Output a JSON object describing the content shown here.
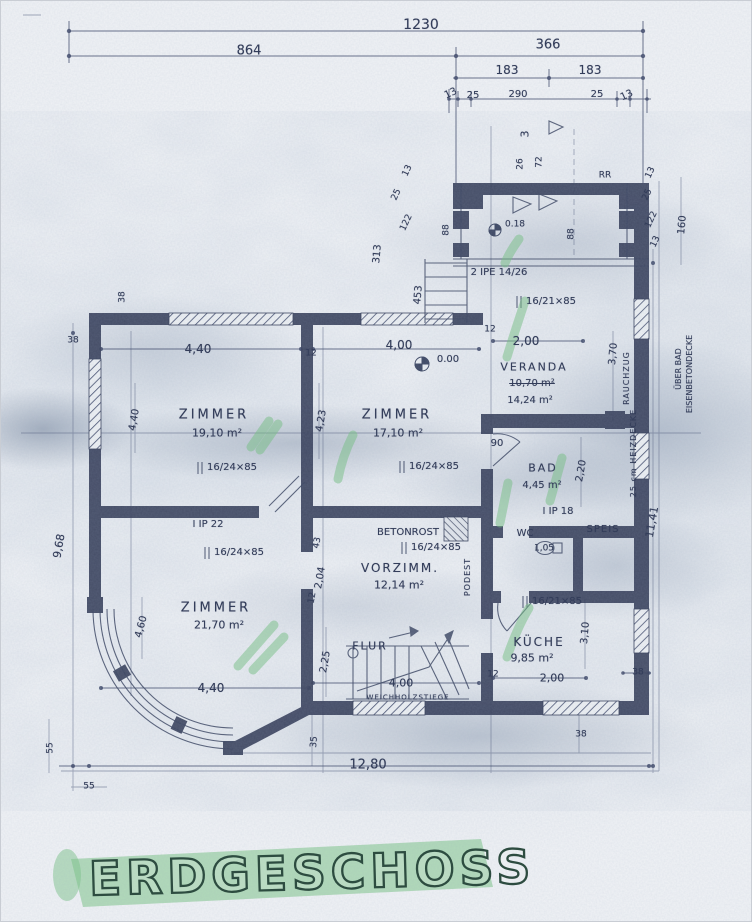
{
  "title": {
    "text": "ERDGESCHOSS"
  },
  "colors": {
    "paper": "#f1f3f6",
    "ink": "#333d5a",
    "wall": "#39415c",
    "highlight_green": "#7cc487",
    "title_ink": "#2d4c40"
  },
  "labels": [
    {
      "name": "dim-total-width",
      "text": "1230",
      "x": 420,
      "y": 24,
      "size": 14
    },
    {
      "name": "dim-864",
      "text": "864",
      "x": 248,
      "y": 50,
      "size": 13
    },
    {
      "name": "dim-366",
      "text": "366",
      "x": 547,
      "y": 44,
      "size": 13
    },
    {
      "name": "dim-183-left",
      "text": "183",
      "x": 506,
      "y": 69,
      "size": 12
    },
    {
      "name": "dim-183-right",
      "text": "183",
      "x": 589,
      "y": 69,
      "size": 12
    },
    {
      "name": "dim-13-a",
      "text": "13",
      "x": 450,
      "y": 93,
      "size": 10,
      "rot": -25
    },
    {
      "name": "dim-25-a",
      "text": "25",
      "x": 472,
      "y": 95,
      "size": 10
    },
    {
      "name": "dim-290",
      "text": "290",
      "x": 517,
      "y": 94,
      "size": 10
    },
    {
      "name": "dim-25-b",
      "text": "25",
      "x": 596,
      "y": 94,
      "size": 10
    },
    {
      "name": "dim-13-b",
      "text": "13",
      "x": 626,
      "y": 95,
      "size": 10,
      "rot": -25
    },
    {
      "name": "dim-3",
      "text": "3",
      "x": 524,
      "y": 133,
      "size": 11,
      "rot": -90
    },
    {
      "name": "dim-26",
      "text": "26",
      "x": 520,
      "y": 163,
      "size": 9,
      "rot": -90
    },
    {
      "name": "dim-72",
      "text": "72",
      "x": 539,
      "y": 161,
      "size": 9,
      "rot": -90
    },
    {
      "name": "note-rr",
      "text": "RR",
      "x": 604,
      "y": 175,
      "size": 9
    },
    {
      "name": "dim-13-porch-left",
      "text": "13",
      "x": 407,
      "y": 170,
      "size": 9,
      "rot": -65
    },
    {
      "name": "dim-25-porch-left",
      "text": "25",
      "x": 396,
      "y": 194,
      "size": 9,
      "rot": -65
    },
    {
      "name": "dim-122-left",
      "text": "122",
      "x": 406,
      "y": 222,
      "size": 9,
      "rot": -65
    },
    {
      "name": "dim-313",
      "text": "313",
      "x": 377,
      "y": 253,
      "size": 10,
      "rot": -85
    },
    {
      "name": "dim-453",
      "text": "453",
      "x": 418,
      "y": 294,
      "size": 10,
      "rot": -85
    },
    {
      "name": "dim-88-left",
      "text": "88",
      "x": 446,
      "y": 229,
      "size": 9,
      "rot": -90
    },
    {
      "name": "dim-88-right",
      "text": "88",
      "x": 571,
      "y": 233,
      "size": 9,
      "rot": -90
    },
    {
      "name": "dim-13-porch-right",
      "text": "13",
      "x": 650,
      "y": 172,
      "size": 9,
      "rot": -65
    },
    {
      "name": "dim-25-porch-right",
      "text": "25",
      "x": 647,
      "y": 194,
      "size": 9,
      "rot": -65
    },
    {
      "name": "dim-122-right",
      "text": "122",
      "x": 651,
      "y": 219,
      "size": 9,
      "rot": -65
    },
    {
      "name": "dim-13-porch-right-2",
      "text": "13",
      "x": 655,
      "y": 241,
      "size": 9,
      "rot": -65
    },
    {
      "name": "dim-160",
      "text": "160",
      "x": 682,
      "y": 224,
      "size": 10,
      "rot": -85
    },
    {
      "name": "level-porch",
      "text": "0.18",
      "x": 514,
      "y": 224,
      "size": 9
    },
    {
      "name": "beam-porch",
      "text": "2 IPE 14/26",
      "x": 498,
      "y": 272,
      "size": 10
    },
    {
      "name": "window-veranda",
      "text": "16/21×85",
      "x": 550,
      "y": 301,
      "size": 10
    },
    {
      "name": "dim-12-veranda",
      "text": "12",
      "x": 489,
      "y": 329,
      "size": 9
    },
    {
      "name": "dim-200-veranda",
      "text": "2,00",
      "x": 525,
      "y": 340,
      "size": 12
    },
    {
      "name": "room-veranda",
      "text": "VERANDA",
      "x": 533,
      "y": 366,
      "size": 11,
      "sp": 2
    },
    {
      "name": "area-veranda-old",
      "text": "10,70 m²",
      "x": 531,
      "y": 383,
      "size": 10,
      "strike": true
    },
    {
      "name": "area-veranda",
      "text": "14,24 m²",
      "x": 529,
      "y": 400,
      "size": 10
    },
    {
      "name": "dim-370",
      "text": "3,70",
      "x": 613,
      "y": 353,
      "size": 10,
      "rot": -85
    },
    {
      "name": "dim-400-zimmer-2",
      "text": "4,00",
      "x": 398,
      "y": 344,
      "size": 12
    },
    {
      "name": "level-zero",
      "text": "0.00",
      "x": 447,
      "y": 359,
      "size": 10
    },
    {
      "name": "dim-440-zimmer-1",
      "text": "4,40",
      "x": 197,
      "y": 348,
      "size": 12
    },
    {
      "name": "dim-12-mid",
      "text": "12",
      "x": 310,
      "y": 353,
      "size": 9
    },
    {
      "name": "dim-38-top",
      "text": "38",
      "x": 122,
      "y": 296,
      "size": 9,
      "rot": -90
    },
    {
      "name": "dim-38-left",
      "text": "38",
      "x": 72,
      "y": 340,
      "size": 9
    },
    {
      "name": "room-zimmer-1",
      "text": "ZIMMER",
      "x": 213,
      "y": 414,
      "size": 13,
      "sp": 3
    },
    {
      "name": "area-zimmer-1",
      "text": "19,10 m²",
      "x": 216,
      "y": 432,
      "size": 11
    },
    {
      "name": "window-zimmer-1",
      "text": "16/24×85",
      "x": 231,
      "y": 467,
      "size": 10
    },
    {
      "name": "dim-440-left",
      "text": "4,40",
      "x": 134,
      "y": 419,
      "size": 10,
      "rot": -80
    },
    {
      "name": "dim-423",
      "text": "4,23",
      "x": 321,
      "y": 420,
      "size": 10,
      "rot": -80
    },
    {
      "name": "room-zimmer-2",
      "text": "ZIMMER",
      "x": 396,
      "y": 414,
      "size": 13,
      "sp": 3
    },
    {
      "name": "area-zimmer-2",
      "text": "17,10 m²",
      "x": 397,
      "y": 432,
      "size": 11
    },
    {
      "name": "window-zimmer-2",
      "text": "16/24×85",
      "x": 433,
      "y": 466,
      "size": 10
    },
    {
      "name": "beam-ip22",
      "text": "I IP 22",
      "x": 207,
      "y": 524,
      "size": 10
    },
    {
      "name": "window-zimmer-3",
      "text": "16/24×85",
      "x": 238,
      "y": 552,
      "size": 10
    },
    {
      "name": "note-betonrost",
      "text": "BETONROST",
      "x": 407,
      "y": 532,
      "size": 10
    },
    {
      "name": "window-vorzimmer",
      "text": "16/24×85",
      "x": 435,
      "y": 547,
      "size": 10
    },
    {
      "name": "room-vorzimmer",
      "text": "VORZIMM.",
      "x": 399,
      "y": 567,
      "size": 12,
      "sp": 2
    },
    {
      "name": "area-vorzimmer",
      "text": "12,14 m²",
      "x": 398,
      "y": 584,
      "size": 11
    },
    {
      "name": "dim-43",
      "text": "43",
      "x": 317,
      "y": 542,
      "size": 9,
      "rot": -80
    },
    {
      "name": "dim-204",
      "text": "2,04",
      "x": 320,
      "y": 577,
      "size": 10,
      "rot": -80
    },
    {
      "name": "dim-12-vorzimmer",
      "text": "12",
      "x": 312,
      "y": 597,
      "size": 9,
      "rot": -80
    },
    {
      "name": "note-podest",
      "text": "PODEST",
      "x": 467,
      "y": 576,
      "size": 8,
      "rot": -90,
      "sp": 1
    },
    {
      "name": "dim-90",
      "text": "90",
      "x": 496,
      "y": 443,
      "size": 10
    },
    {
      "name": "room-bad",
      "text": "BAD",
      "x": 542,
      "y": 467,
      "size": 11,
      "sp": 2
    },
    {
      "name": "area-bad",
      "text": "4,45 m²",
      "x": 541,
      "y": 485,
      "size": 10
    },
    {
      "name": "dim-220",
      "text": "2,20",
      "x": 581,
      "y": 470,
      "size": 10,
      "rot": -80
    },
    {
      "name": "beam-ip18",
      "text": "I IP 18",
      "x": 557,
      "y": 511,
      "size": 10
    },
    {
      "name": "room-wc",
      "text": "WC",
      "x": 524,
      "y": 533,
      "size": 10
    },
    {
      "name": "area-wc",
      "text": "1,05",
      "x": 543,
      "y": 548,
      "size": 9
    },
    {
      "name": "room-speis",
      "text": "SPEIS",
      "x": 602,
      "y": 529,
      "size": 10,
      "sp": 1
    },
    {
      "name": "room-zimmer-3",
      "text": "ZIMMER",
      "x": 215,
      "y": 607,
      "size": 13,
      "sp": 3
    },
    {
      "name": "area-zimmer-3",
      "text": "21,70 m²",
      "x": 218,
      "y": 624,
      "size": 11
    },
    {
      "name": "dim-460",
      "text": "4,60",
      "x": 141,
      "y": 626,
      "size": 10,
      "rot": -75
    },
    {
      "name": "dim-440-zimmer-3",
      "text": "4,40",
      "x": 210,
      "y": 687,
      "size": 12
    },
    {
      "name": "dim-968",
      "text": "9,68",
      "x": 58,
      "y": 545,
      "size": 11,
      "rot": -80
    },
    {
      "name": "dim-225",
      "text": "2,25",
      "x": 325,
      "y": 661,
      "size": 10,
      "rot": -80
    },
    {
      "name": "room-flur",
      "text": "FLUR",
      "x": 369,
      "y": 645,
      "size": 11,
      "sp": 2
    },
    {
      "name": "dim-400-flur",
      "text": "4,00",
      "x": 400,
      "y": 682,
      "size": 11
    },
    {
      "name": "note-stairs",
      "text": "WEICHHOLZSTIEGE",
      "x": 407,
      "y": 697,
      "size": 7,
      "sp": 1
    },
    {
      "name": "dim-12-flur",
      "text": "12",
      "x": 492,
      "y": 674,
      "size": 9
    },
    {
      "name": "window-kueche",
      "text": "16/21×85",
      "x": 556,
      "y": 601,
      "size": 10
    },
    {
      "name": "room-kueche",
      "text": "KÜCHE",
      "x": 538,
      "y": 641,
      "size": 12,
      "sp": 2
    },
    {
      "name": "area-kueche",
      "text": "9,85 m²",
      "x": 531,
      "y": 657,
      "size": 11
    },
    {
      "name": "dim-310",
      "text": "3,10",
      "x": 585,
      "y": 632,
      "size": 10,
      "rot": -85
    },
    {
      "name": "dim-200-kueche",
      "text": "2,00",
      "x": 551,
      "y": 677,
      "size": 11
    },
    {
      "name": "dim-38-kueche",
      "text": "38",
      "x": 637,
      "y": 672,
      "size": 9
    },
    {
      "name": "dim-38-bottom",
      "text": "38",
      "x": 580,
      "y": 734,
      "size": 9
    },
    {
      "name": "dim-1280",
      "text": "12,80",
      "x": 367,
      "y": 764,
      "size": 13
    },
    {
      "name": "dim-35",
      "text": "35",
      "x": 314,
      "y": 741,
      "size": 9,
      "rot": -85
    },
    {
      "name": "dim-55-vertical",
      "text": "55",
      "x": 50,
      "y": 747,
      "size": 9,
      "rot": -90
    },
    {
      "name": "dim-55-horizontal",
      "text": "55",
      "x": 88,
      "y": 786,
      "size": 9
    },
    {
      "name": "dim-1141",
      "text": "11,41",
      "x": 651,
      "y": 521,
      "size": 11,
      "rot": -80
    },
    {
      "name": "note-rauchzug",
      "text": "RAUCHZUG",
      "x": 626,
      "y": 377,
      "size": 8,
      "rot": -90,
      "sp": 1
    },
    {
      "name": "note-heizdecke",
      "text": "25 cm HEIZDECKE",
      "x": 633,
      "y": 452,
      "size": 8,
      "rot": -90,
      "sp": 1
    },
    {
      "name": "note-ueber-bad",
      "text": "ÜBER BAD",
      "x": 678,
      "y": 368,
      "size": 8,
      "rot": -90
    },
    {
      "name": "note-eisenbetondecke",
      "text": "EISENBETONDECKE",
      "x": 689,
      "y": 373,
      "size": 8,
      "rot": -90
    }
  ]
}
